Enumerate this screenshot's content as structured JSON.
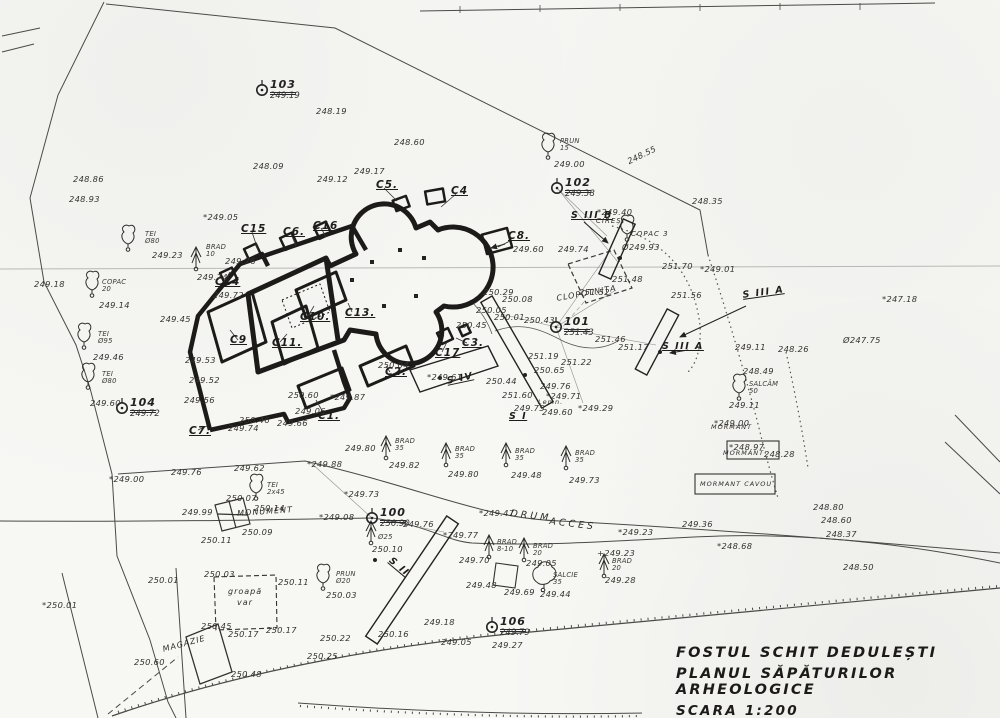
{
  "title": {
    "line1": "FOSTUL SCHIT DEDULEȘTI",
    "line2": "PLANUL SĂPĂTURILOR ARHEOLOGICE",
    "line3": "SCARA 1:200"
  },
  "stations": [
    {
      "id": "100",
      "elev": "250.90",
      "x": 372,
      "y": 518
    },
    {
      "id": "101",
      "elev": "251.43",
      "x": 556,
      "y": 327
    },
    {
      "id": "102",
      "elev": "249.38",
      "x": 557,
      "y": 188
    },
    {
      "id": "103",
      "elev": "249.19",
      "x": 262,
      "y": 90
    },
    {
      "id": "104",
      "elev": "249.72",
      "x": 122,
      "y": 408
    },
    {
      "id": "106",
      "elev": "249.79",
      "x": 492,
      "y": 627
    }
  ],
  "sections": [
    {
      "id": "S I",
      "x": 509,
      "y": 412,
      "r": 0
    },
    {
      "id": "S II",
      "x": 393,
      "y": 556,
      "r": 40
    },
    {
      "id": "S III A",
      "x": 662,
      "y": 342,
      "r": 0
    },
    {
      "id": "S III A",
      "x": 742,
      "y": 291,
      "r": -8
    },
    {
      "id": "S III B",
      "x": 571,
      "y": 211,
      "r": 0
    },
    {
      "id": "S IV",
      "x": 446,
      "y": 377,
      "r": -12
    }
  ],
  "structures": [
    {
      "id": "C1.",
      "x": 318,
      "y": 411
    },
    {
      "id": "C2.",
      "x": 385,
      "y": 367
    },
    {
      "id": "C3.",
      "x": 462,
      "y": 338
    },
    {
      "id": "C4",
      "x": 451,
      "y": 186
    },
    {
      "id": "C5.",
      "x": 376,
      "y": 180
    },
    {
      "id": "C6.",
      "x": 283,
      "y": 227
    },
    {
      "id": "C7.",
      "x": 189,
      "y": 426
    },
    {
      "id": "C8.",
      "x": 508,
      "y": 231
    },
    {
      "id": "C9",
      "x": 230,
      "y": 335
    },
    {
      "id": "C10.",
      "x": 300,
      "y": 312
    },
    {
      "id": "C11.",
      "x": 272,
      "y": 338
    },
    {
      "id": "C13.",
      "x": 345,
      "y": 308
    },
    {
      "id": "C14",
      "x": 215,
      "y": 277
    },
    {
      "id": "C15",
      "x": 241,
      "y": 224
    },
    {
      "id": "C16",
      "x": 313,
      "y": 221
    },
    {
      "id": "C17",
      "x": 435,
      "y": 348
    }
  ],
  "features": [
    {
      "t": "CLOPOTNIȚA",
      "x": 556,
      "y": 295,
      "r": -10,
      "s": 8
    },
    {
      "t": "DRUM",
      "x": 511,
      "y": 509,
      "r": 7,
      "s": 9.5,
      "ls": 3
    },
    {
      "t": "ACCES",
      "x": 550,
      "y": 517,
      "r": 7,
      "s": 9.5,
      "ls": 3
    },
    {
      "t": "MONUMENT",
      "x": 237,
      "y": 510,
      "r": -4,
      "s": 8
    },
    {
      "t": "MORMANT",
      "x": 711,
      "y": 424,
      "s": 6.5
    },
    {
      "t": "MORMANT",
      "x": 723,
      "y": 450,
      "s": 6.5
    },
    {
      "t": "MORMANT CAVOU",
      "x": 700,
      "y": 481,
      "s": 6.5
    },
    {
      "t": "MAGAZIE",
      "x": 162,
      "y": 646,
      "r": -15,
      "s": 8
    },
    {
      "t": "groapă",
      "x": 228,
      "y": 588,
      "s": 8
    },
    {
      "t": "var",
      "x": 237,
      "y": 599,
      "s": 8
    },
    {
      "t": "Lemn.",
      "x": 538,
      "y": 399,
      "s": 6.5
    },
    {
      "t": "CIREȘ",
      "x": 596,
      "y": 218,
      "s": 7
    },
    {
      "t": "COPAC 3",
      "x": 631,
      "y": 231,
      "s": 7
    }
  ],
  "elevations": [
    {
      "t": "*249.05",
      "x": 203,
      "y": 213
    },
    {
      "t": "249.76",
      "x": 225,
      "y": 257
    },
    {
      "t": "249.72",
      "x": 213,
      "y": 291
    },
    {
      "t": "248.86",
      "x": 73,
      "y": 175
    },
    {
      "t": "248.93",
      "x": 69,
      "y": 195
    },
    {
      "t": "249.18",
      "x": 34,
      "y": 280
    },
    {
      "t": "248.09",
      "x": 253,
      "y": 162
    },
    {
      "t": "249.12",
      "x": 317,
      "y": 175
    },
    {
      "t": "248.19",
      "x": 316,
      "y": 107
    },
    {
      "t": "248.60",
      "x": 394,
      "y": 138
    },
    {
      "t": "249.17",
      "x": 354,
      "y": 167
    },
    {
      "t": "248.55",
      "x": 626,
      "y": 158,
      "r": -26
    },
    {
      "t": "248.35",
      "x": 692,
      "y": 197
    },
    {
      "t": "*249.40",
      "x": 597,
      "y": 208
    },
    {
      "t": "Ø249.93",
      "x": 622,
      "y": 243
    },
    {
      "t": "249.74",
      "x": 558,
      "y": 245
    },
    {
      "t": "250.29",
      "x": 483,
      "y": 288
    },
    {
      "t": "250.08",
      "x": 502,
      "y": 295
    },
    {
      "t": "250.05",
      "x": 476,
      "y": 306
    },
    {
      "t": "250.01",
      "x": 494,
      "y": 313
    },
    {
      "t": "250.45",
      "x": 456,
      "y": 321
    },
    {
      "t": "250.43",
      "x": 524,
      "y": 316
    },
    {
      "t": "251.52",
      "x": 579,
      "y": 288
    },
    {
      "t": "251.56",
      "x": 671,
      "y": 291
    },
    {
      "t": "251.70",
      "x": 662,
      "y": 262
    },
    {
      "t": "*249.01",
      "x": 700,
      "y": 265
    },
    {
      "t": "251.48",
      "x": 612,
      "y": 275
    },
    {
      "t": "251.46",
      "x": 595,
      "y": 335
    },
    {
      "t": "251.19",
      "x": 528,
      "y": 352
    },
    {
      "t": "251.22",
      "x": 561,
      "y": 358
    },
    {
      "t": "250.65",
      "x": 534,
      "y": 366
    },
    {
      "t": "251.17",
      "x": 618,
      "y": 343
    },
    {
      "t": "250.44",
      "x": 486,
      "y": 377
    },
    {
      "t": "251.60",
      "x": 502,
      "y": 391
    },
    {
      "t": "249.75",
      "x": 514,
      "y": 404
    },
    {
      "t": "*249.71",
      "x": 546,
      "y": 392
    },
    {
      "t": "249.76",
      "x": 540,
      "y": 382
    },
    {
      "t": "249.60",
      "x": 542,
      "y": 408
    },
    {
      "t": "*249.29",
      "x": 578,
      "y": 404
    },
    {
      "t": "*247.18",
      "x": 882,
      "y": 295
    },
    {
      "t": "Ø247.75",
      "x": 843,
      "y": 336
    },
    {
      "t": "249.11",
      "x": 735,
      "y": 343
    },
    {
      "t": "248.26",
      "x": 778,
      "y": 345
    },
    {
      "t": "248.49",
      "x": 743,
      "y": 367
    },
    {
      "t": "249.11",
      "x": 729,
      "y": 401
    },
    {
      "t": "*249.00",
      "x": 714,
      "y": 419
    },
    {
      "t": "*248.97",
      "x": 729,
      "y": 443
    },
    {
      "t": "248.28",
      "x": 764,
      "y": 450
    },
    {
      "t": "249.45",
      "x": 160,
      "y": 315
    },
    {
      "t": "249.53",
      "x": 185,
      "y": 356
    },
    {
      "t": "249.52",
      "x": 189,
      "y": 376
    },
    {
      "t": "249.56",
      "x": 184,
      "y": 396
    },
    {
      "t": "250.60",
      "x": 288,
      "y": 391
    },
    {
      "t": "250.46",
      "x": 239,
      "y": 416
    },
    {
      "t": "249.74",
      "x": 228,
      "y": 424
    },
    {
      "t": "249.66",
      "x": 277,
      "y": 419
    },
    {
      "t": "249.06",
      "x": 295,
      "y": 407
    },
    {
      "t": "*249.87",
      "x": 330,
      "y": 393
    },
    {
      "t": "*249.61",
      "x": 427,
      "y": 373
    },
    {
      "t": "250.04",
      "x": 378,
      "y": 361
    },
    {
      "t": "249.60",
      "x": 513,
      "y": 245
    },
    {
      "t": "249.62",
      "x": 234,
      "y": 464
    },
    {
      "t": "249.76",
      "x": 171,
      "y": 468
    },
    {
      "t": "249.80",
      "x": 345,
      "y": 444
    },
    {
      "t": "*249.88",
      "x": 307,
      "y": 460
    },
    {
      "t": "*249.73",
      "x": 344,
      "y": 490
    },
    {
      "t": "*249.08",
      "x": 319,
      "y": 513
    },
    {
      "t": "*249.00",
      "x": 109,
      "y": 475
    },
    {
      "t": "249.76",
      "x": 403,
      "y": 520
    },
    {
      "t": "*249.77",
      "x": 443,
      "y": 531
    },
    {
      "t": "*249.47",
      "x": 479,
      "y": 509
    },
    {
      "t": "*249.23",
      "x": 618,
      "y": 528
    },
    {
      "t": "249.36",
      "x": 682,
      "y": 520
    },
    {
      "t": "+249.23",
      "x": 597,
      "y": 549
    },
    {
      "t": "*248.68",
      "x": 717,
      "y": 542
    },
    {
      "t": "248.80",
      "x": 813,
      "y": 503
    },
    {
      "t": "248.60",
      "x": 821,
      "y": 516
    },
    {
      "t": "248.37",
      "x": 826,
      "y": 530
    },
    {
      "t": "248.50",
      "x": 843,
      "y": 563
    },
    {
      "t": "249.48",
      "x": 466,
      "y": 581
    },
    {
      "t": "249.69",
      "x": 504,
      "y": 588
    },
    {
      "t": "249.18",
      "x": 424,
      "y": 618
    },
    {
      "t": "249.05",
      "x": 441,
      "y": 638
    },
    {
      "t": "249.27",
      "x": 492,
      "y": 641
    },
    {
      "t": "250.22",
      "x": 320,
      "y": 634
    },
    {
      "t": "250.25",
      "x": 307,
      "y": 652
    },
    {
      "t": "250.16",
      "x": 378,
      "y": 630
    },
    {
      "t": "250.48",
      "x": 231,
      "y": 670
    },
    {
      "t": "250.60",
      "x": 134,
      "y": 658
    },
    {
      "t": "250.45",
      "x": 201,
      "y": 622
    },
    {
      "t": "250.17",
      "x": 266,
      "y": 626
    },
    {
      "t": "250.17",
      "x": 228,
      "y": 630
    },
    {
      "t": "250.03",
      "x": 204,
      "y": 570
    },
    {
      "t": "250.11",
      "x": 278,
      "y": 578
    },
    {
      "t": "*250.01",
      "x": 42,
      "y": 601
    },
    {
      "t": "250.01",
      "x": 148,
      "y": 576
    },
    {
      "t": "250.07",
      "x": 226,
      "y": 494
    },
    {
      "t": "249.99",
      "x": 182,
      "y": 508
    },
    {
      "t": "250.09",
      "x": 242,
      "y": 528
    },
    {
      "t": "250.11",
      "x": 201,
      "y": 536
    },
    {
      "t": "250.14",
      "x": 254,
      "y": 504
    },
    {
      "t": "250.10",
      "x": 372,
      "y": 545
    }
  ],
  "trees": [
    {
      "g": "leaf",
      "x": 128,
      "y": 242,
      "n": "TEI",
      "d": "Ø80",
      "e": "249.23",
      "nx": 145,
      "ny": 231,
      "ex": 152,
      "ey": 251
    },
    {
      "g": "leaf",
      "x": 92,
      "y": 288,
      "n": "COPAC",
      "d": "20",
      "e": "249.14",
      "nx": 102,
      "ny": 279,
      "ex": 99,
      "ey": 301
    },
    {
      "g": "leaf",
      "x": 84,
      "y": 340,
      "n": "TEI",
      "d": "Ø95",
      "e": "249.46",
      "nx": 98,
      "ny": 331,
      "ex": 93,
      "ey": 353
    },
    {
      "g": "leaf",
      "x": 88,
      "y": 380,
      "n": "TEI",
      "d": "Ø80",
      "e": "249.60",
      "nx": 102,
      "ny": 371,
      "ex": 90,
      "ey": 399
    },
    {
      "g": "fir",
      "x": 196,
      "y": 260,
      "n": "BRAD",
      "d": "10",
      "e": "249.74",
      "nx": 206,
      "ny": 244,
      "ex": 197,
      "ey": 273
    },
    {
      "g": "leaf",
      "x": 548,
      "y": 150,
      "n": "PRUN",
      "d": "15",
      "e": "249.00",
      "nx": 560,
      "ny": 138,
      "ex": 554,
      "ey": 160
    },
    {
      "g": "leaf",
      "x": 627,
      "y": 232,
      "n": "",
      "d": "",
      "e": "",
      "nx": 0,
      "ny": 0,
      "ex": 0,
      "ey": 0
    },
    {
      "g": "leaf",
      "x": 739,
      "y": 391,
      "n": "SALCÂM",
      "d": "50",
      "e": "249.11",
      "nx": 749,
      "ny": 381,
      "ex": 0,
      "ey": 0
    },
    {
      "g": "leaf",
      "x": 323,
      "y": 581,
      "n": "PRUN",
      "d": "Ø20",
      "e": "250.03",
      "nx": 336,
      "ny": 571,
      "ex": 326,
      "ey": 591
    },
    {
      "g": "leaf",
      "x": 256,
      "y": 491,
      "n": "TEI",
      "d": "2x45",
      "e": "",
      "nx": 267,
      "ny": 482,
      "ex": 0,
      "ey": 0
    },
    {
      "g": "fir",
      "x": 386,
      "y": 449,
      "n": "BRAD",
      "d": "35",
      "e": "249.82",
      "nx": 395,
      "ny": 438,
      "ex": 389,
      "ey": 461
    },
    {
      "g": "fir",
      "x": 446,
      "y": 456,
      "n": "BRAD",
      "d": "35",
      "e": "249.80",
      "nx": 455,
      "ny": 446,
      "ex": 448,
      "ey": 470
    },
    {
      "g": "fir",
      "x": 506,
      "y": 456,
      "n": "BRAD",
      "d": "35",
      "e": "249.48",
      "nx": 515,
      "ny": 448,
      "ex": 511,
      "ey": 471
    },
    {
      "g": "fir",
      "x": 566,
      "y": 459,
      "n": "BRAD",
      "d": "35",
      "e": "249.73",
      "nx": 575,
      "ny": 450,
      "ex": 569,
      "ey": 476
    },
    {
      "g": "fir",
      "x": 489,
      "y": 548,
      "n": "BRAD",
      "d": "8-10",
      "e": "249.70",
      "nx": 497,
      "ny": 539,
      "ex": 459,
      "ey": 556
    },
    {
      "g": "fir",
      "x": 524,
      "y": 551,
      "n": "BRAD",
      "d": "20",
      "e": "249.05",
      "nx": 533,
      "ny": 543,
      "ex": 526,
      "ey": 559
    },
    {
      "g": "willow",
      "x": 543,
      "y": 580,
      "n": "SALCIE",
      "d": "35",
      "e": "249.44",
      "nx": 553,
      "ny": 572,
      "ex": 540,
      "ey": 590
    },
    {
      "g": "fir",
      "x": 604,
      "y": 567,
      "n": "BRAD",
      "d": "20",
      "e": "249.28",
      "nx": 612,
      "ny": 558,
      "ex": 605,
      "ey": 576
    },
    {
      "g": "fir",
      "x": 371,
      "y": 534,
      "n": "",
      "d": "Ø25",
      "e": "250.10",
      "nx": 378,
      "ny": 534,
      "ex": 0,
      "ey": 0
    }
  ]
}
